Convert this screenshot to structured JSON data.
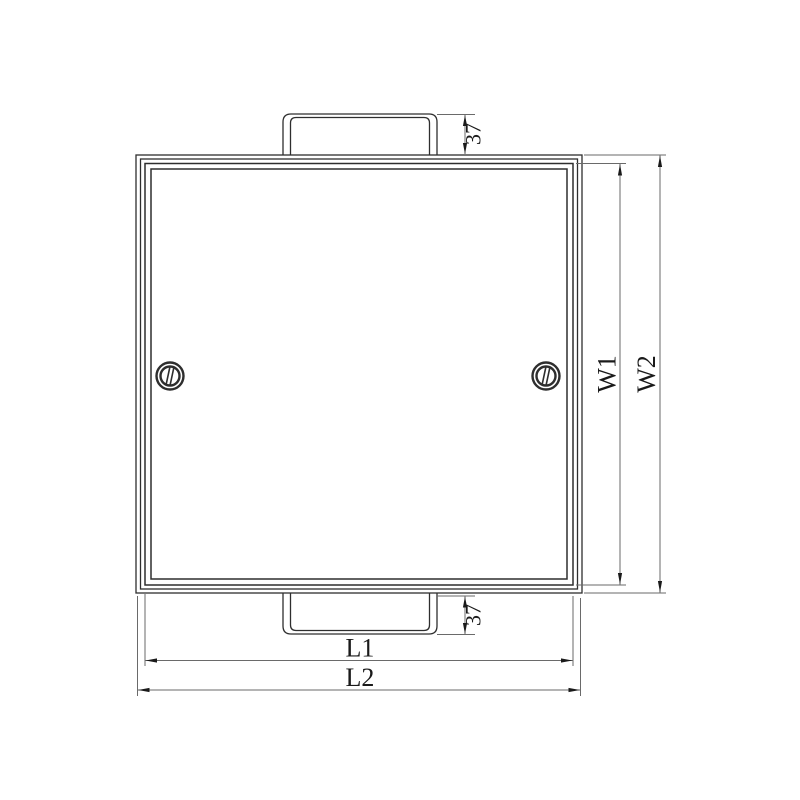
{
  "drawing": {
    "background": "#ffffff",
    "colors": {
      "edge": "#2e2e2e",
      "dimension": "#6a6a6a",
      "text": "#1a1a1a"
    },
    "dimensions": {
      "top_tab_depth": {
        "label": "37"
      },
      "bottom_tab_depth": {
        "label": "37"
      },
      "inner_length": {
        "label": "L1"
      },
      "outer_length": {
        "label": "L2"
      },
      "inner_width": {
        "label": "W1"
      },
      "outer_width": {
        "label": "W2"
      }
    }
  }
}
